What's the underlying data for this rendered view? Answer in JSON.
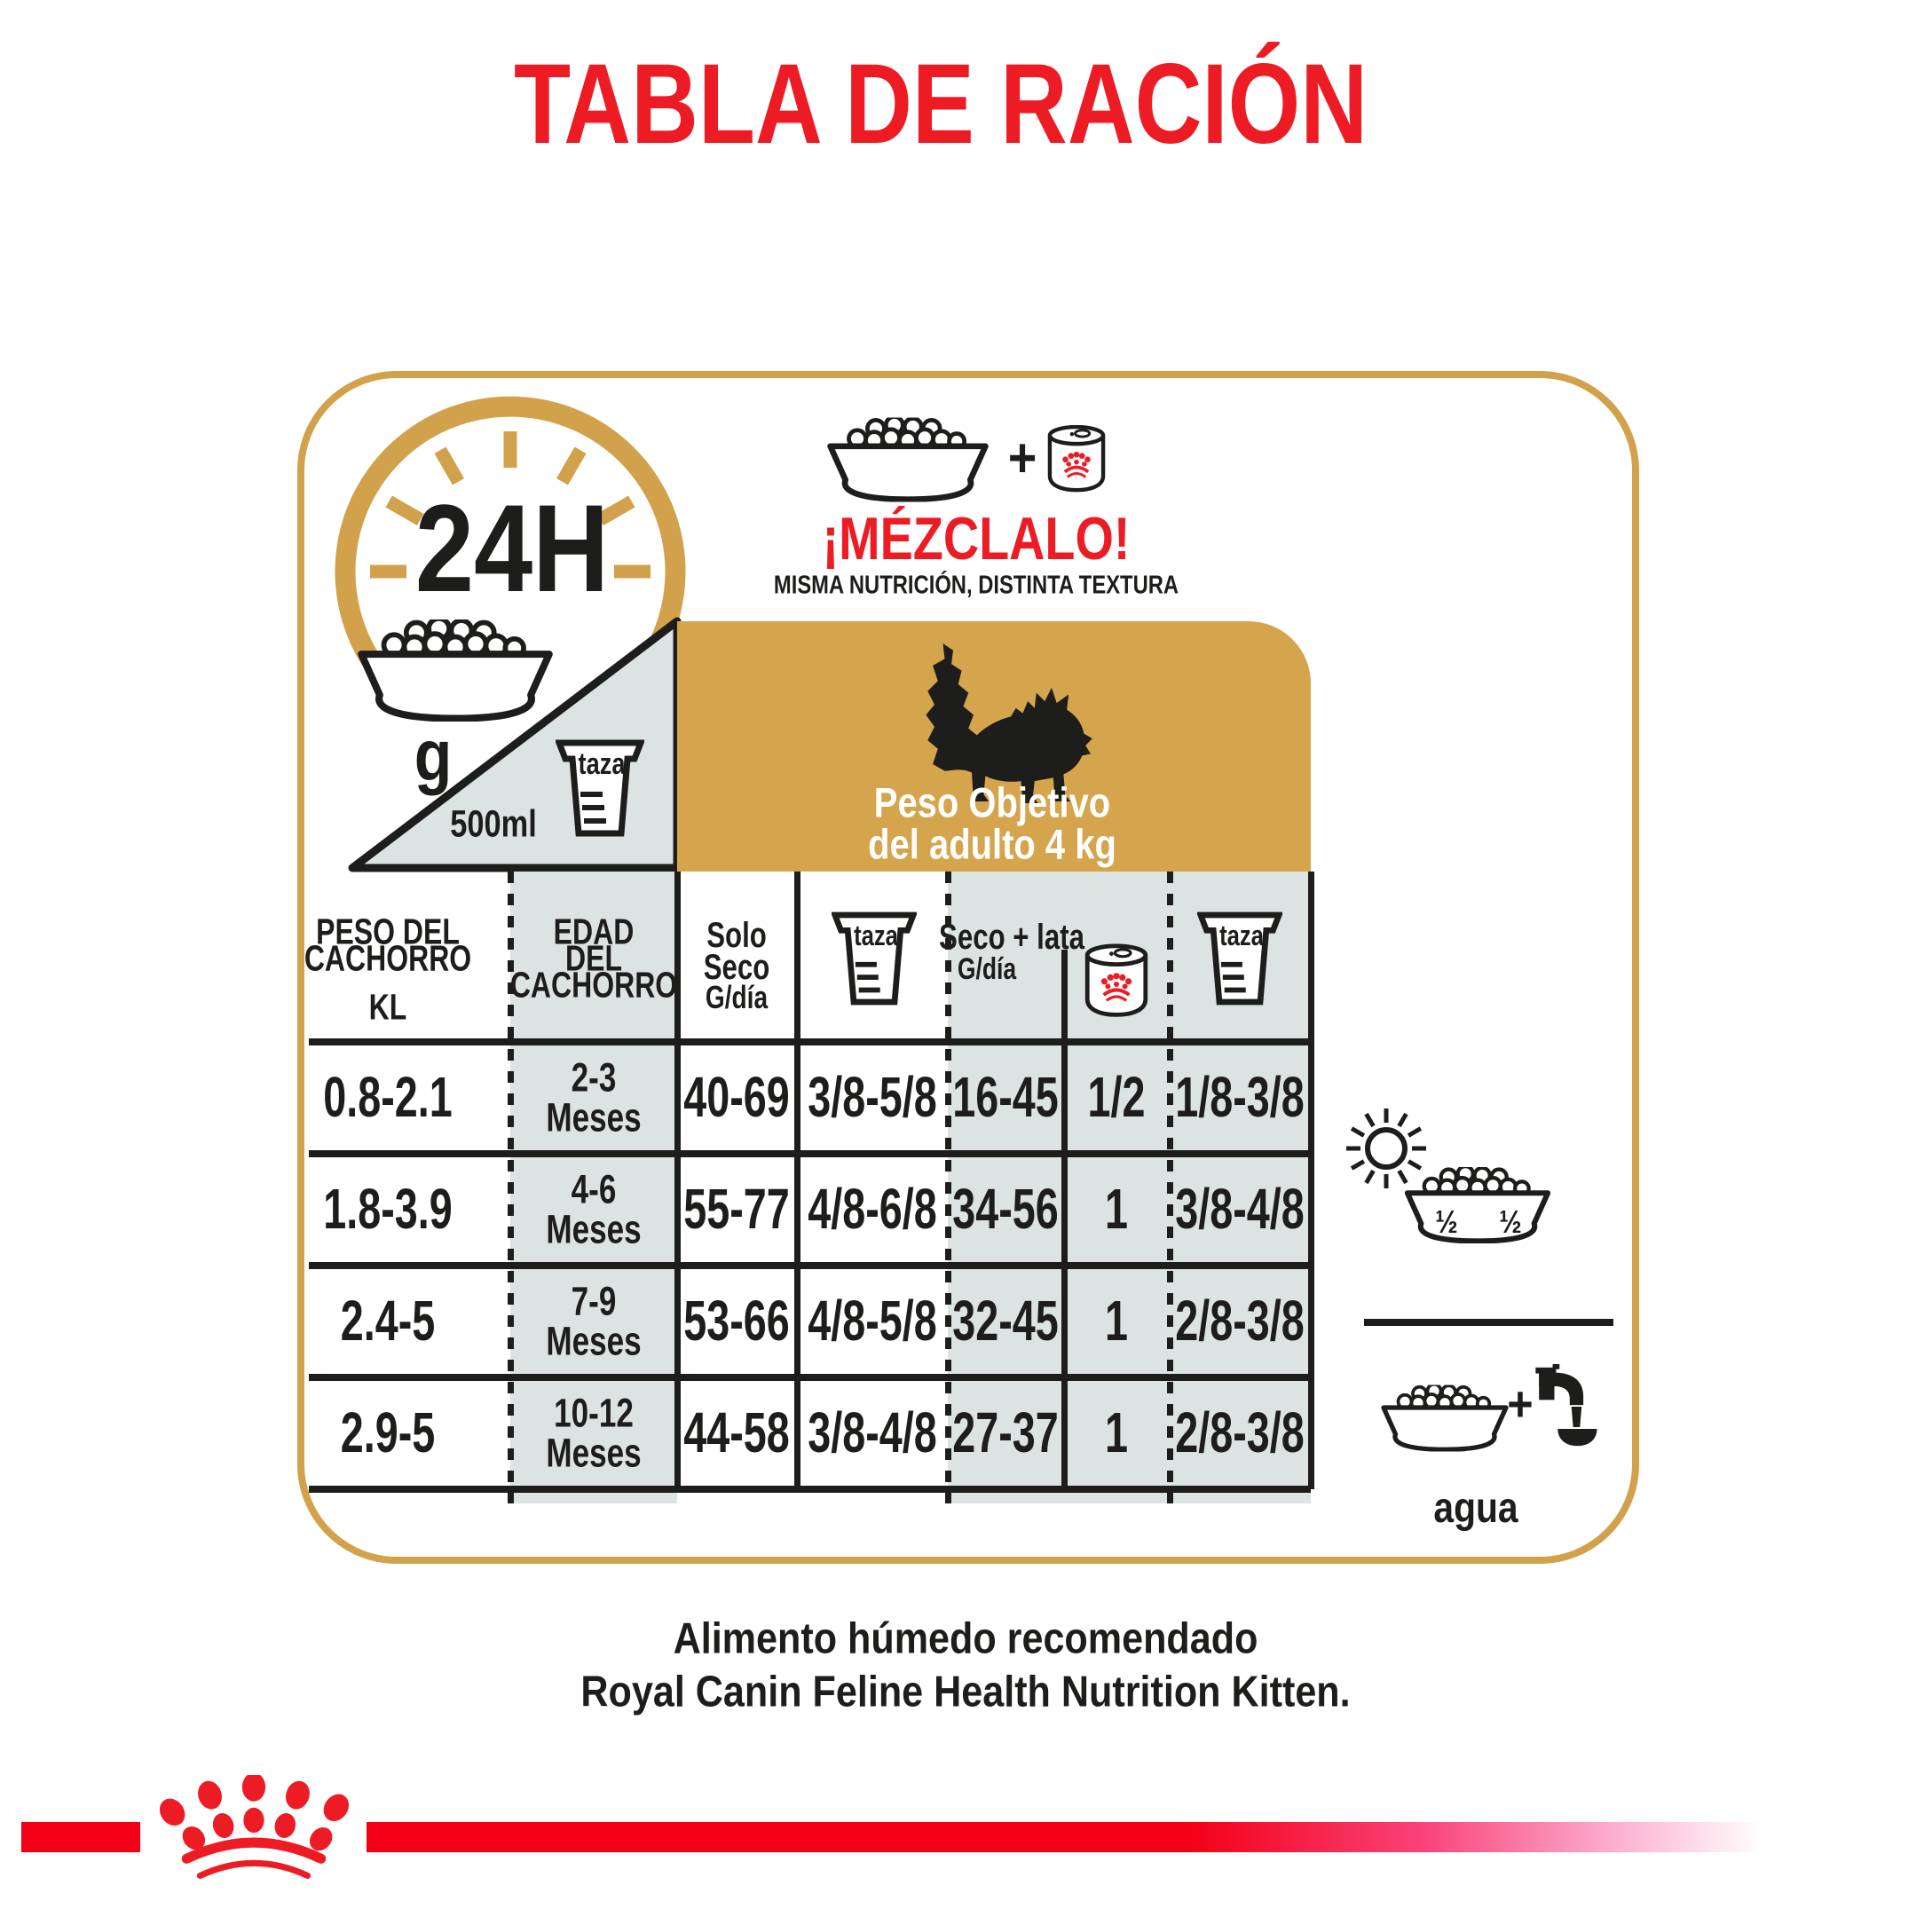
{
  "title": "TABLA DE RACIÓN",
  "clock": {
    "label": "24H",
    "unit": "g"
  },
  "measuring_cup": {
    "label": "taza",
    "volume": "500ml"
  },
  "mix": {
    "plus": "+",
    "headline": "¡MÉZCLALO!",
    "subheadline": "MISMA NUTRICIÓN, DISTINTA TEXTURA"
  },
  "target_weight": {
    "line1": "Peso Objetivo",
    "line2": "del adulto 4 kg"
  },
  "table": {
    "headers": {
      "col1": [
        "PESO DEL",
        "CACHORRO",
        "KL"
      ],
      "col2": [
        "EDAD",
        "DEL",
        "CACHORRO"
      ],
      "col3": [
        "Solo",
        "Seco",
        "G/día"
      ],
      "col4_icon": "measuring-cup",
      "col5": {
        "line1": "Seco + lata",
        "line2": "G/día"
      },
      "col6_icon": "food-can",
      "col7_icon": "measuring-cup"
    },
    "rows": [
      {
        "peso": "0.8-2.1",
        "edad": [
          "2-3",
          "Meses"
        ],
        "solo_seco": "40-69",
        "taza_seco": "3/8-5/8",
        "seco_lata": "16-45",
        "lata": "1/2",
        "taza_mixto": "1/8-3/8"
      },
      {
        "peso": "1.8-3.9",
        "edad": [
          "4-6",
          "Meses"
        ],
        "solo_seco": "55-77",
        "taza_seco": "4/8-6/8",
        "seco_lata": "34-56",
        "lata": "1",
        "taza_mixto": "3/8-4/8"
      },
      {
        "peso": "2.4-5",
        "edad": [
          "7-9",
          "Meses"
        ],
        "solo_seco": "53-66",
        "taza_seco": "4/8-5/8",
        "seco_lata": "32-45",
        "lata": "1",
        "taza_mixto": "2/8-3/8"
      },
      {
        "peso": "2.9-5",
        "edad": [
          "10-12",
          "Meses"
        ],
        "solo_seco": "44-58",
        "taza_seco": "3/8-4/8",
        "seco_lata": "27-37",
        "lata": "1",
        "taza_mixto": "2/8-3/8"
      }
    ]
  },
  "feeding_split": {
    "left": "½",
    "right": "½"
  },
  "water": {
    "plus": "+",
    "label": "agua"
  },
  "footer": {
    "line1": "Alimento húmedo recomendado",
    "line2": "Royal Canin Feline Health Nutrition Kitten."
  },
  "colors": {
    "red": "#ed1c24",
    "gold_border": "#d2a14b",
    "tan_box": "#d5a54e",
    "gray_cell": "#dce4e3",
    "ink": "#1d1d1b"
  }
}
